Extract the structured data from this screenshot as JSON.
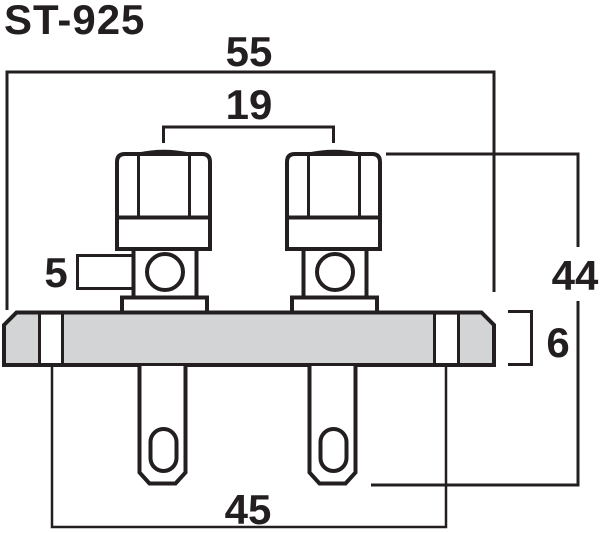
{
  "title": "ST-925",
  "drawing": {
    "description": "dual-binding-post-speaker-terminal-dimensional-drawing",
    "labels": {
      "overall_width_mm": "55",
      "post_spacing_mm": "19",
      "wire_hole_diameter_mm": "5",
      "overall_height_mm": "44",
      "plate_thickness_mm": "6",
      "mounting_span_mm": "45"
    },
    "colors": {
      "line": "#231f20",
      "plate_fill": "#d3d4d6",
      "background": "#ffffff"
    }
  }
}
